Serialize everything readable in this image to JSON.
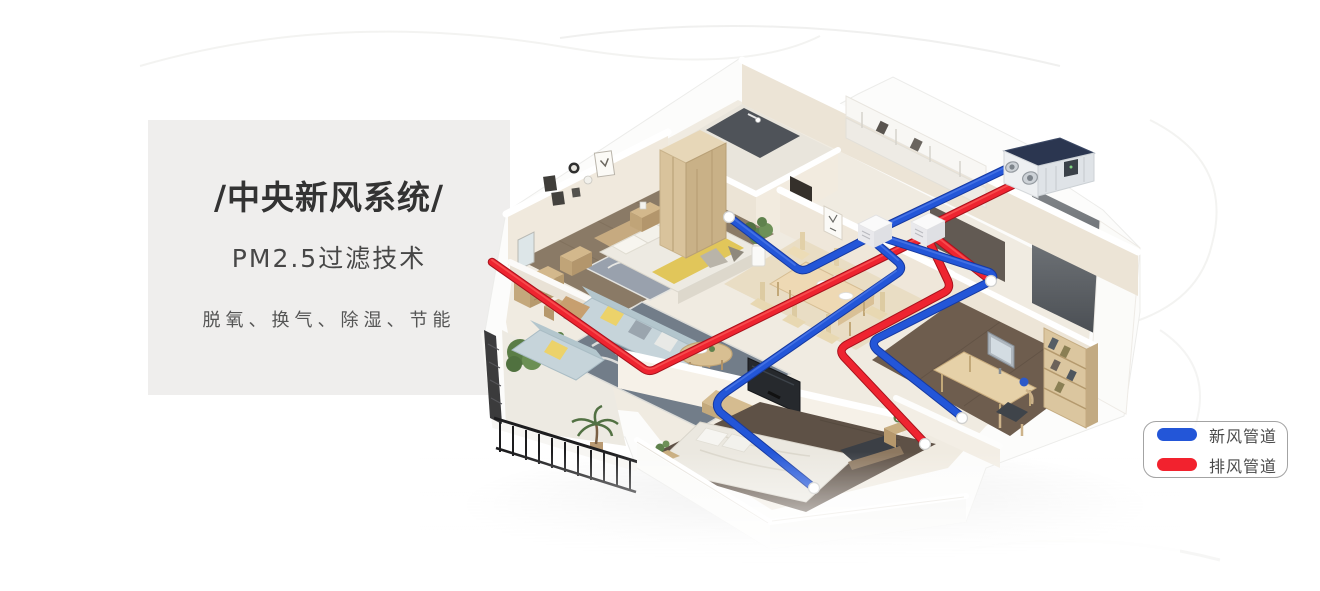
{
  "panel": {
    "title": "/中央新风系统/",
    "subtitle": "PM2.5过滤技术",
    "tagline": "脱氧、换气、除湿、节能"
  },
  "legend": {
    "items": [
      {
        "label": "新风管道",
        "color": "#2356d8"
      },
      {
        "label": "排风管道",
        "color": "#f2222e"
      }
    ]
  },
  "illustration": {
    "fresh_air_duct_color": "#2356d8",
    "exhaust_duct_color": "#ee2430",
    "unit_top_color": "#2b3650"
  }
}
